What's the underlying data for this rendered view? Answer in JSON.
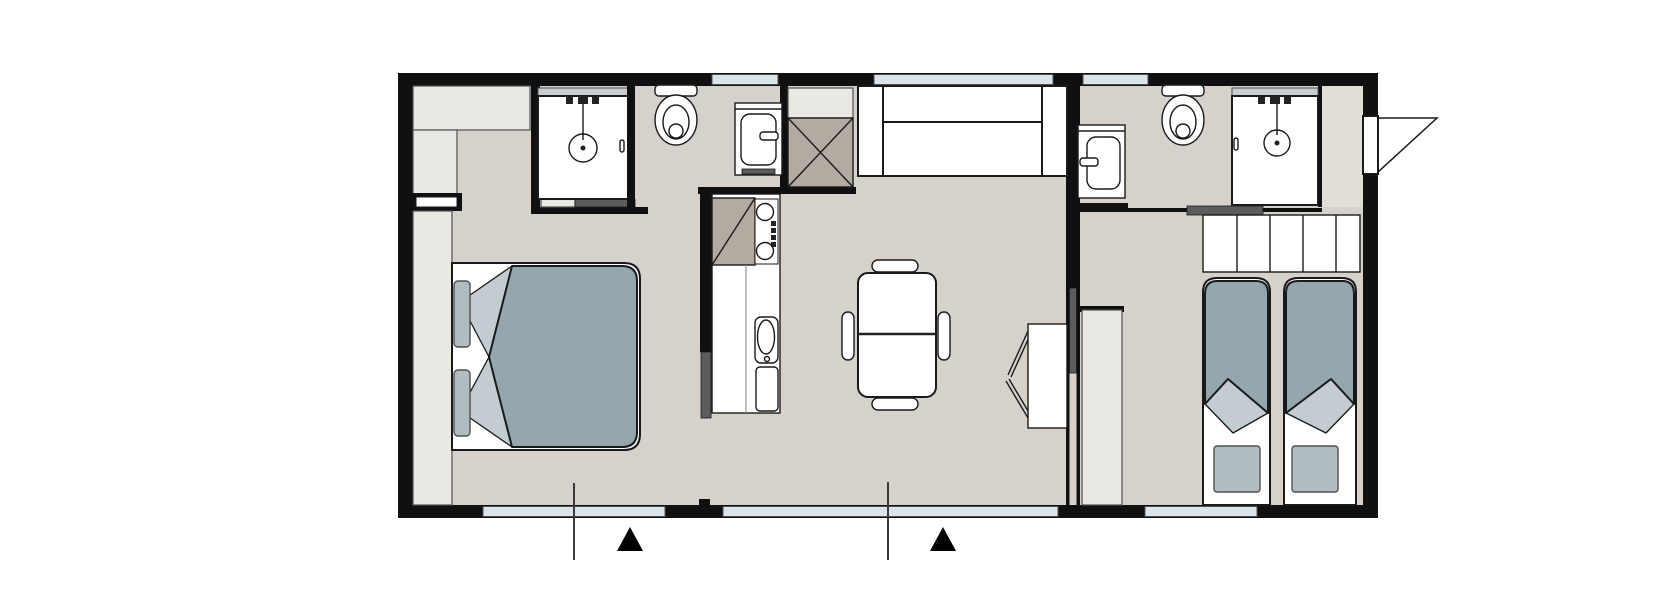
{
  "canvas": {
    "width": 1680,
    "height": 612,
    "background": "#ffffff"
  },
  "colors": {
    "wall": "#101010",
    "floor": "#d6d2cb",
    "floor_light": "#e1ded8",
    "furniture": "#eae8e3",
    "white": "#ffffff",
    "window": "#d9e5eb",
    "glass": "#c9ced1",
    "outline": "#1a1a1a",
    "outline_soft": "#4f4f4f",
    "duvet": "#94a6ae",
    "fold": "#c3ccd1",
    "pillow": "#b1bcc1",
    "wood": "#b3aaa2",
    "slider": "#5a5c5e",
    "marker": "#000000"
  },
  "plan": {
    "type": "mobile-home floor plan, top view, no text labels",
    "rooms_inferred_from_symbols": [
      "double bedroom",
      "shower room 1",
      "kitchen",
      "living-dining",
      "shower room 2",
      "twin bedroom",
      "entrance vestibule"
    ],
    "furniture_symbols": [
      "double-bed",
      "wardrobes",
      "shower-1",
      "toilet-1",
      "washbasin-1",
      "tech-cupboard-crossed",
      "kitchen-hob",
      "kitchen-sink",
      "sofa",
      "dining-table",
      "four-chairs",
      "wall-desk",
      "sliding-doors",
      "washbasin-2",
      "toilet-2",
      "shower-2",
      "headboard-cabinets",
      "single-bed-1",
      "single-bed-2",
      "entry-door-swing",
      "section-line-1",
      "section-line-2",
      "entrance-arrow-1",
      "entrance-arrow-2"
    ],
    "windows_count": 6
  }
}
